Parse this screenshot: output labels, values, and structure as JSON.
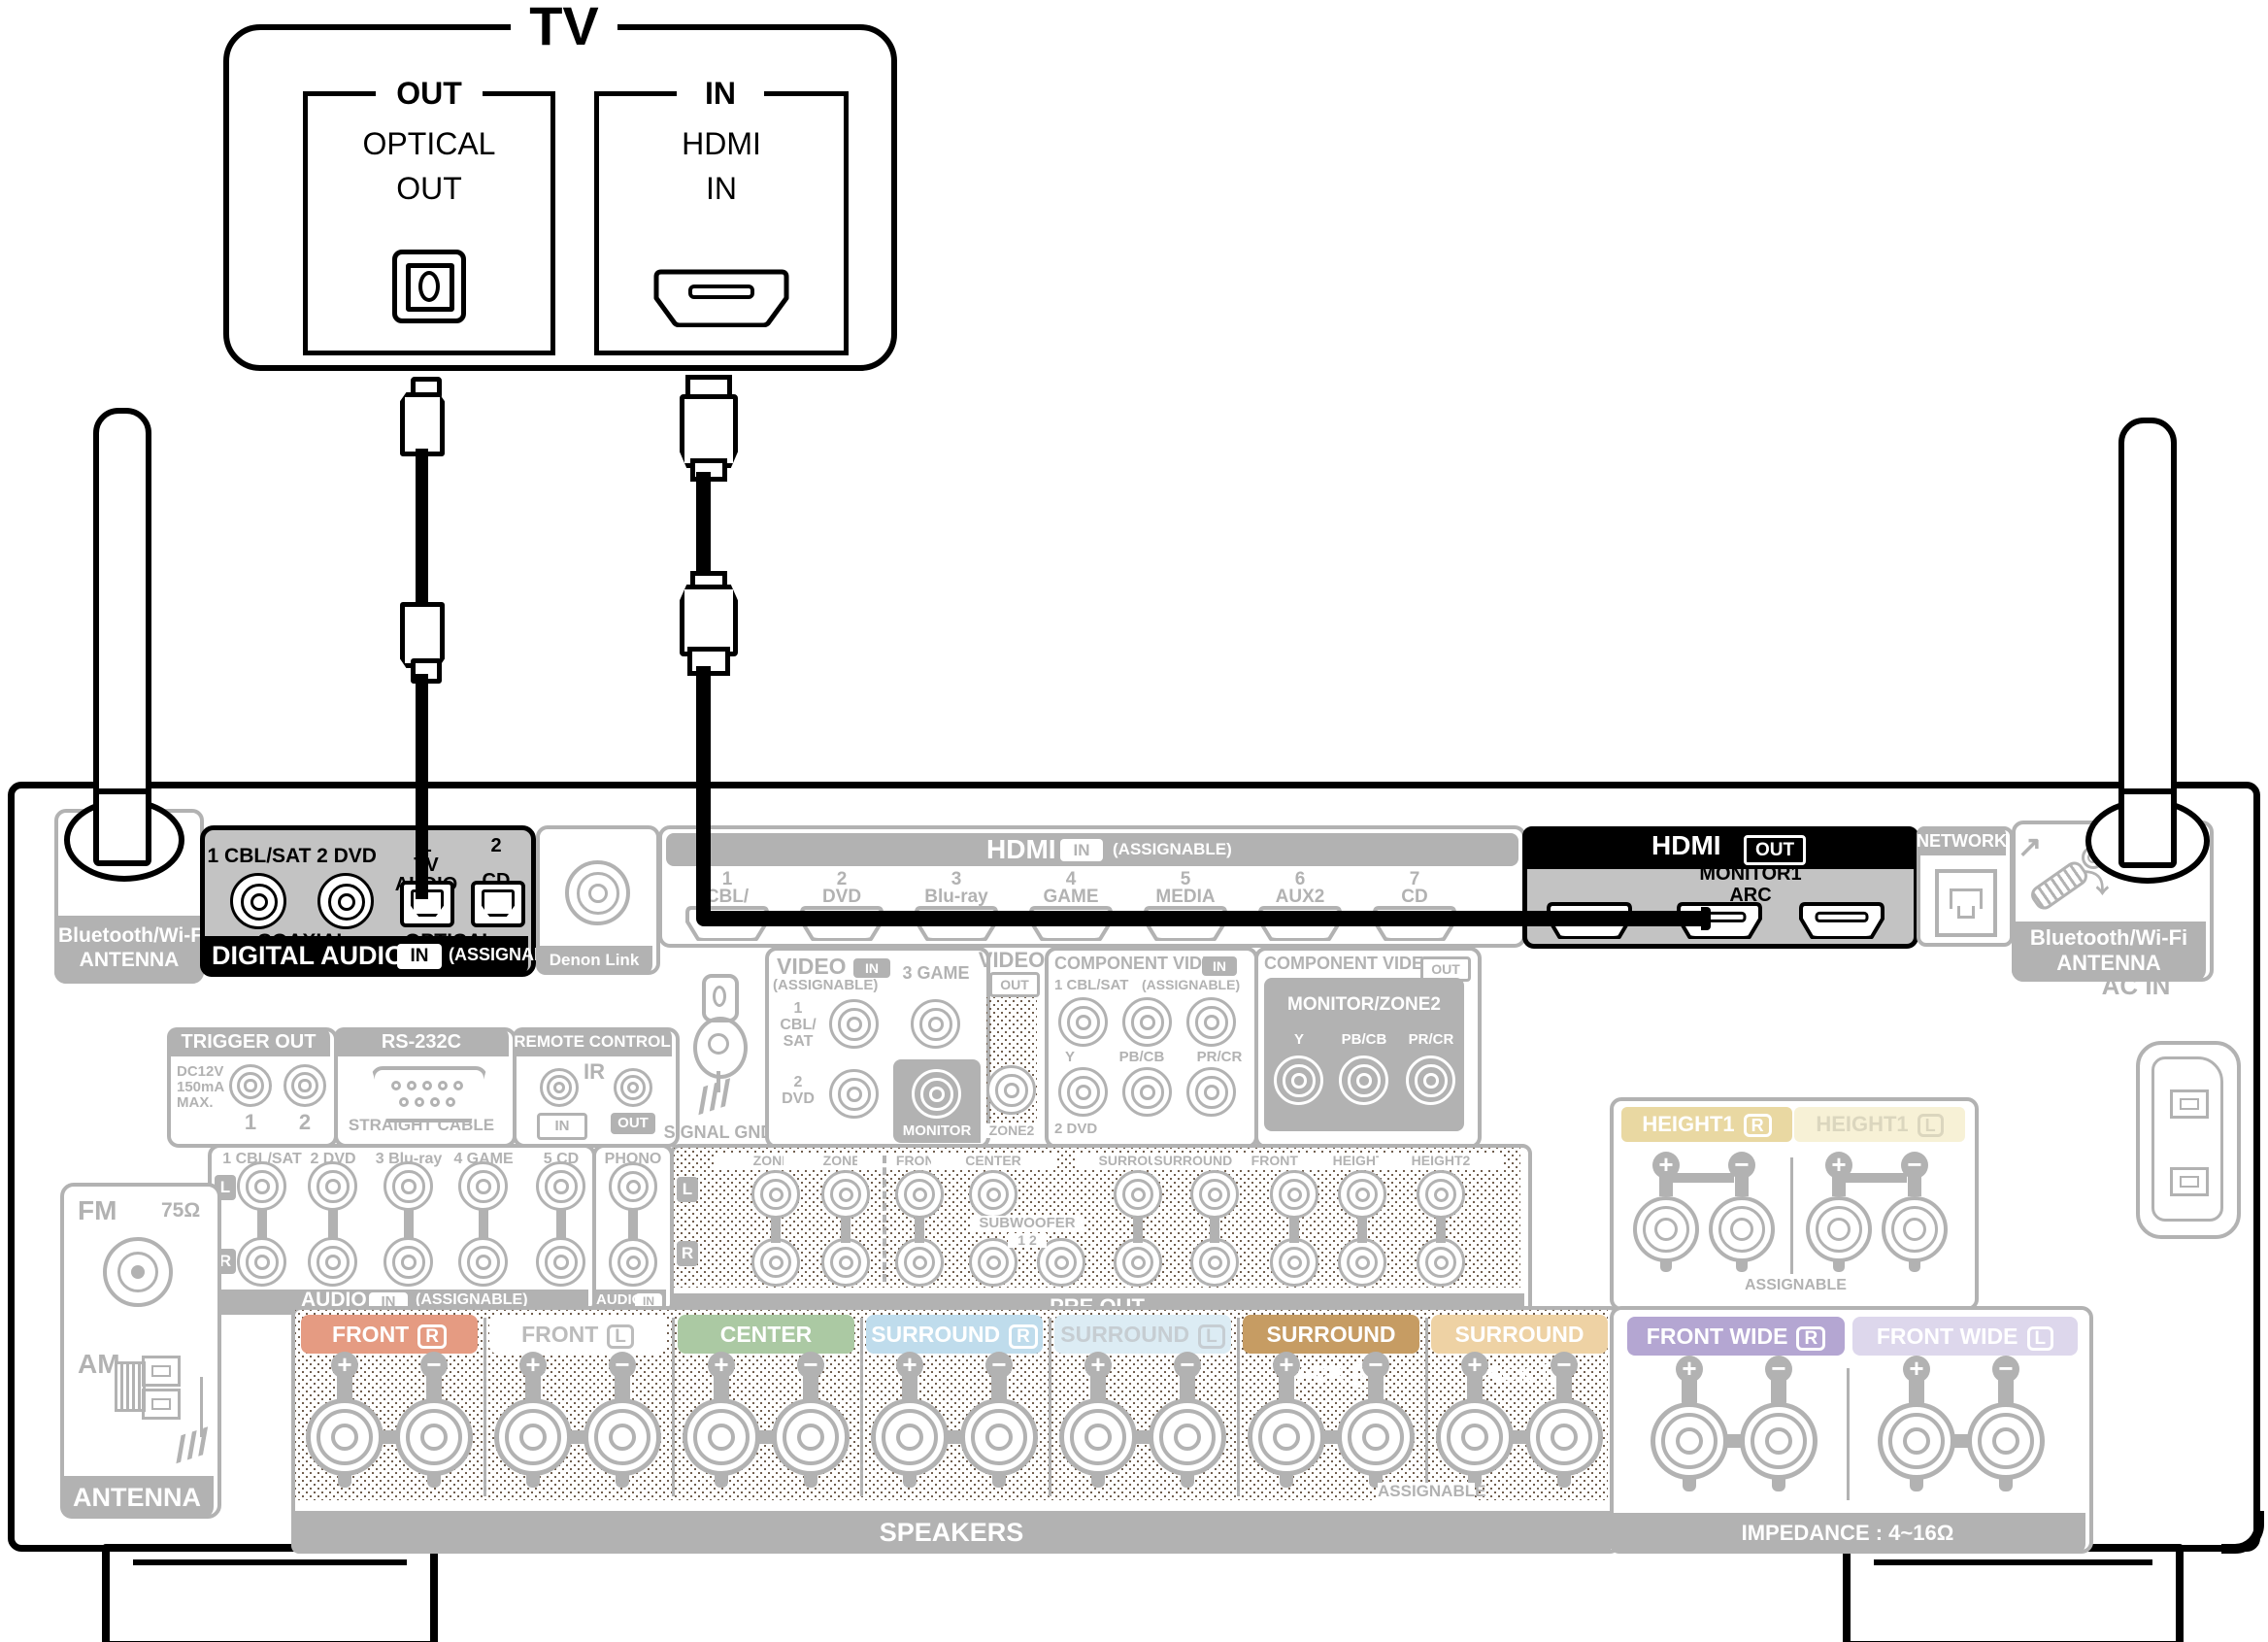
{
  "tv": {
    "title": "TV",
    "optical_group": {
      "title": "OUT",
      "line1": "OPTICAL",
      "line2": "OUT"
    },
    "hdmi_group": {
      "title": "IN",
      "line1": "HDMI",
      "line2": "IN"
    }
  },
  "cables": {
    "optical": "optical-cable",
    "hdmi": "hdmi-cable"
  },
  "receiver": {
    "bt_left": {
      "line1": "Bluetooth/Wi-Fi",
      "line2": "ANTENNA"
    },
    "digital_audio": {
      "coax": [
        {
          "label": "1 CBL/SAT"
        },
        {
          "label": "2 DVD"
        }
      ],
      "opt": [
        {
          "lines": [
            "1",
            "TV",
            "AUDIO"
          ]
        },
        {
          "lines": [
            "2",
            "CD"
          ]
        }
      ],
      "coax_caption": "COAXIAL",
      "opt_caption": "OPTICAL",
      "banner_title": "DIGITAL AUDIO",
      "banner_io": "IN",
      "banner_note": "(ASSIGNABLE)"
    },
    "denon_link": "Denon Link HD",
    "hdmi_in": {
      "title": "HDMI",
      "io": "IN",
      "note": "(ASSIGNABLE)",
      "ports": [
        [
          "1",
          "CBL/",
          "SAT"
        ],
        [
          "2",
          "DVD"
        ],
        [
          "3",
          "Blu-ray"
        ],
        [
          "4",
          "GAME"
        ],
        [
          "5",
          "MEDIA",
          "PLAYER"
        ],
        [
          "6",
          "AUX2"
        ],
        [
          "7",
          "CD"
        ]
      ]
    },
    "hdmi_out": {
      "title": "HDMI",
      "io": "OUT",
      "line1": "MONITOR1",
      "line2": "ARC"
    },
    "network": "NETWORK",
    "bt_right": {
      "line1": "Bluetooth/Wi-Fi",
      "line2": "ANTENNA"
    },
    "ac_in": "AC IN",
    "trigger": {
      "title": "TRIGGER OUT",
      "notes": [
        "DC12V",
        "150mA",
        "MAX."
      ],
      "jacks": [
        "1",
        "2"
      ]
    },
    "rs232c": {
      "title": "RS-232C",
      "caption": "STRAIGHT CABLE"
    },
    "remote": {
      "title": "REMOTE CONTROL",
      "ir": "IR",
      "tag_in": "IN",
      "tag_out": "OUT"
    },
    "signal_gnd": "SIGNAL GND",
    "video_in": {
      "title": "VIDEO",
      "io": "IN",
      "note": "(ASSIGNABLE)",
      "jack1": [
        "1",
        "CBL/",
        "SAT"
      ],
      "jack2": "3 GAME",
      "jack3": [
        "2",
        "DVD"
      ],
      "monitor": "MONITOR"
    },
    "video_out": {
      "title": "VIDEO",
      "io": "OUT",
      "zone2": "ZONE2"
    },
    "comp_in": {
      "title": "COMPONENT VIDEO",
      "io": "IN",
      "note": "(ASSIGNABLE)",
      "top": "1 CBL/SAT",
      "sig": [
        "Y",
        "PB/CB",
        "PR/CR"
      ],
      "bottom": "2 DVD"
    },
    "comp_out": {
      "title": "COMPONENT VIDEO",
      "io": "OUT",
      "monitor": "MONITOR/ZONE2",
      "sig": [
        "Y",
        "PB/CB",
        "PR/CR"
      ]
    },
    "audio_in": {
      "cols": [
        "1 CBL/SAT",
        "2 DVD",
        "3 Blu-ray",
        "4 GAME",
        "5 CD"
      ],
      "rows": [
        "L",
        "R"
      ],
      "banner_title": "AUDIO",
      "banner_io": "IN",
      "banner_note": "(ASSIGNABLE)"
    },
    "phono": {
      "label": "PHONO",
      "banner_title": "AUDIO",
      "banner_io": "IN"
    },
    "pre_out": {
      "rows": [
        "L",
        "R"
      ],
      "cols": [
        "ZONE2",
        "ZONE3",
        "FRONT",
        "CENTER",
        "SURROUND",
        "SURROUND BACK",
        "FRONT WIDE",
        "HEIGHT1",
        "HEIGHT2"
      ],
      "sub_label": "SUBWOOFER",
      "sub_nums": "1 2",
      "banner": "PRE OUT"
    },
    "speakers": {
      "banner": "SPEAKERS",
      "assignable": "ASSIGNABLE",
      "sections": [
        {
          "name": "FRONT",
          "ch": "R",
          "bg": "#e59b82",
          "fg": "#ffffff"
        },
        {
          "name": "FRONT",
          "ch": "L",
          "bg": "#ffffff",
          "fg": "#bcbcbc"
        },
        {
          "name": "CENTER",
          "ch": "",
          "bg": "#abc9a3",
          "fg": "#ffffff"
        },
        {
          "name": "SURROUND",
          "ch": "R",
          "bg": "#bfdcec",
          "fg": "#ffffff"
        },
        {
          "name": "SURROUND",
          "ch": "L",
          "bg": "#dcecf4",
          "fg": "#c6cdd2"
        },
        {
          "name": "SURROUND BACK",
          "ch": "R",
          "bg": "#c69c63",
          "fg": "#ffffff"
        },
        {
          "name": "SURROUND BACK",
          "ch": "L",
          "bg": "#eed2a4",
          "fg": "#ffffff"
        }
      ]
    },
    "height1": {
      "assignable": "ASSIGNABLE",
      "sections": [
        {
          "name": "HEIGHT1",
          "ch": "R",
          "bg": "#e9d8a2",
          "fg": "#ffffff"
        },
        {
          "name": "HEIGHT1",
          "ch": "L",
          "bg": "#f7f1d6",
          "fg": "#dbd6be"
        }
      ]
    },
    "front_wide": {
      "impedance": "IMPEDANCE : 4~16Ω",
      "sections": [
        {
          "name": "FRONT WIDE",
          "ch": "R",
          "bg": "#b4a6d2",
          "fg": "#ffffff"
        },
        {
          "name": "FRONT WIDE",
          "ch": "L",
          "bg": "#ddd7ec",
          "fg": "#ffffff"
        }
      ]
    },
    "antenna": {
      "fm": "FM",
      "ohm": "75Ω",
      "am": "AM",
      "banner": "ANTENNA"
    }
  }
}
